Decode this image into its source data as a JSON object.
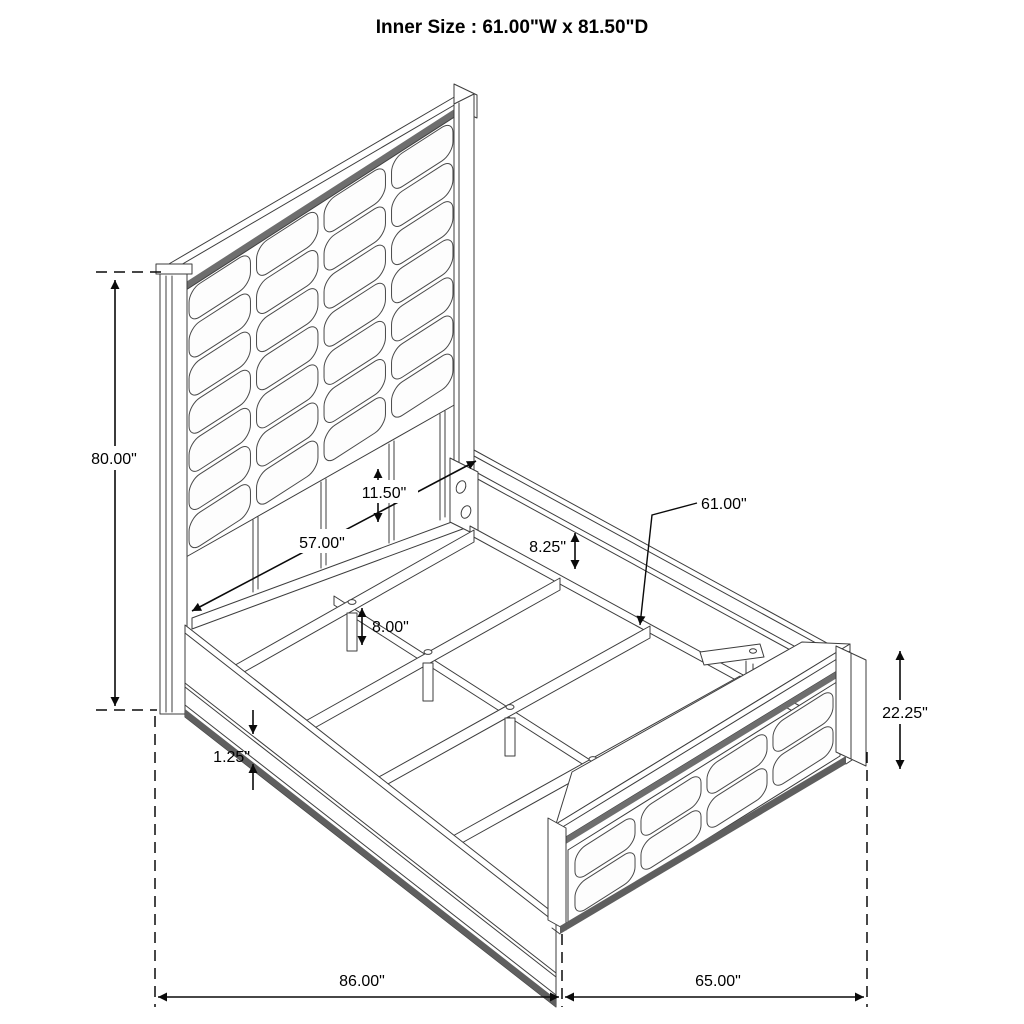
{
  "title": "Inner Size : 61.00\"W x 81.50\"D",
  "dims": {
    "headboard_height": "80.00\"",
    "headboard_inner_width": "57.00\"",
    "headboard_gap": "11.50\"",
    "rail_top_depth": "8.25\"",
    "slat_callout": "61.00\"",
    "leg_height": "8.00\"",
    "rail_lip": "1.25\"",
    "footboard_height": "22.25\"",
    "overall_depth": "86.00\"",
    "overall_width": "65.00\""
  },
  "grids": {
    "headboard": {
      "cols": 4,
      "rows": 7
    },
    "footboard": {
      "cols": 4,
      "rows": 2
    }
  },
  "colors": {
    "line": "#3d3d3d",
    "dimension": "#0a0a0a",
    "shadow_dark": "#5f5f5f",
    "shadow_mid": "#6e6e6e",
    "background": "#ffffff"
  }
}
